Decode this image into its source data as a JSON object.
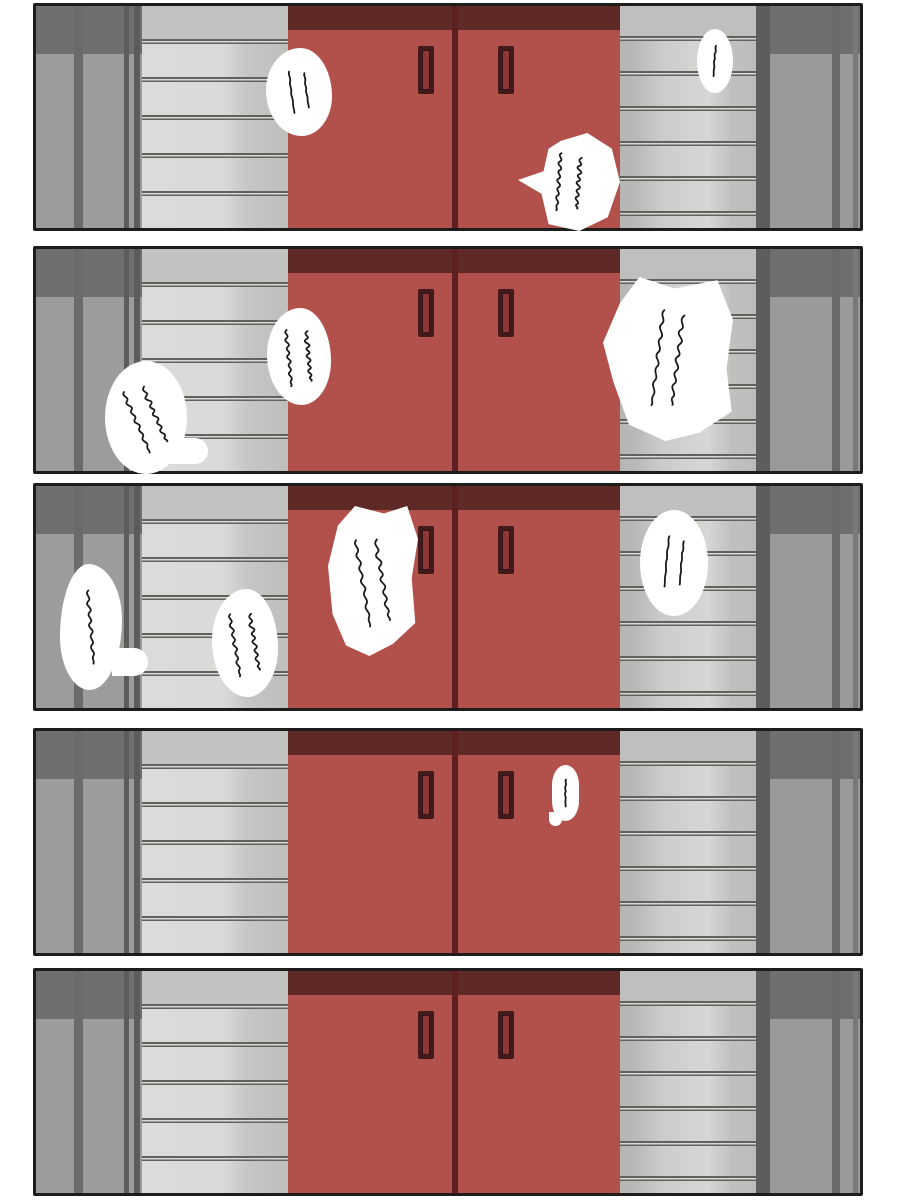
{
  "comic": {
    "description": "Five-panel comic strip: a closed red double door (elevator style) flanked by grey striped walls; white speech bubbles contain illegible handwritten scribbles.",
    "colors": {
      "page_background": "#ffffff",
      "door_red": "#b2504b",
      "door_top_band": "#5e2927",
      "door_seam": "#5c2023",
      "handle_dark": "#421a1c",
      "handle_inner": "#8a3834",
      "wall_light": "#dadad8",
      "wall_shade": "#bebebc",
      "wall_line": "#61615d",
      "column_base": "#9c9c9a",
      "column_shadow": "#6f6f6d",
      "panel_border": "#1e1d1c",
      "bubble_fill": "#ffffff",
      "scribble_ink": "#1a1a1a"
    },
    "panels": [
      {
        "label": "panel-1",
        "scene": "red-double-door",
        "bubbles": [
          {
            "shape": "blob",
            "x": 266,
            "y": 48,
            "w": 66,
            "h": 88,
            "lines": 2,
            "tilt": -8,
            "thin": true,
            "text": "(illegible handwriting)"
          },
          {
            "shape": "spiky",
            "x": 518,
            "y": 133,
            "w": 102,
            "h": 98,
            "lines": 2,
            "tilt": 4,
            "thin": false,
            "text": "(illegible handwriting)"
          },
          {
            "shape": "oval",
            "x": 697,
            "y": 29,
            "w": 36,
            "h": 64,
            "lines": 1,
            "tilt": 4,
            "thin": true,
            "text": "(illegible handwriting)"
          }
        ]
      },
      {
        "label": "panel-2",
        "scene": "red-double-door",
        "bubbles": [
          {
            "shape": "oval",
            "x": 105,
            "y": 361,
            "w": 82,
            "h": 113,
            "lines": 2,
            "tilt": -24,
            "thin": false,
            "text": "(illegible handwriting)",
            "tail": {
              "x": 160,
              "y": 438,
              "w": 48,
              "h": 26,
              "round": "0 14px 14px 6px"
            }
          },
          {
            "shape": "blob",
            "x": 267,
            "y": 308,
            "w": 64,
            "h": 97,
            "lines": 2,
            "tilt": -6,
            "thin": false,
            "text": "(illegible handwriting)"
          },
          {
            "shape": "poly1",
            "x": 603,
            "y": 277,
            "w": 130,
            "h": 164,
            "lines": 2,
            "tilt": 7,
            "thin": false,
            "text": "(illegible handwriting)"
          }
        ]
      },
      {
        "label": "panel-3",
        "scene": "red-double-door",
        "bubbles": [
          {
            "shape": "blob2",
            "x": 60,
            "y": 564,
            "w": 62,
            "h": 126,
            "lines": 1,
            "tilt": -5,
            "thin": false,
            "text": "(illegible handwriting)",
            "tail": {
              "x": 112,
              "y": 648,
              "w": 36,
              "h": 28,
              "round": "0 14px 14px 0"
            }
          },
          {
            "shape": "blob",
            "x": 212,
            "y": 589,
            "w": 66,
            "h": 108,
            "lines": 2,
            "tilt": -10,
            "thin": false,
            "text": "(illegible handwriting)"
          },
          {
            "shape": "poly2",
            "x": 328,
            "y": 506,
            "w": 90,
            "h": 150,
            "lines": 2,
            "tilt": -10,
            "thin": false,
            "text": "(illegible handwriting)"
          },
          {
            "shape": "oval",
            "x": 640,
            "y": 510,
            "w": 68,
            "h": 106,
            "lines": 2,
            "tilt": 5,
            "thin": true,
            "text": "(illegible handwriting)"
          }
        ]
      },
      {
        "label": "panel-4",
        "scene": "red-double-door",
        "bubbles": [
          {
            "shape": "pill",
            "x": 552,
            "y": 765,
            "w": 27,
            "h": 56,
            "lines": 1,
            "tilt": 0,
            "thin": true,
            "text": "(illegible handwriting)",
            "tail": {
              "x": 549,
              "y": 812,
              "w": 13,
              "h": 14,
              "round": "0 0 9px 9px"
            }
          }
        ]
      },
      {
        "label": "panel-5",
        "scene": "red-double-door",
        "bubbles": []
      }
    ]
  }
}
